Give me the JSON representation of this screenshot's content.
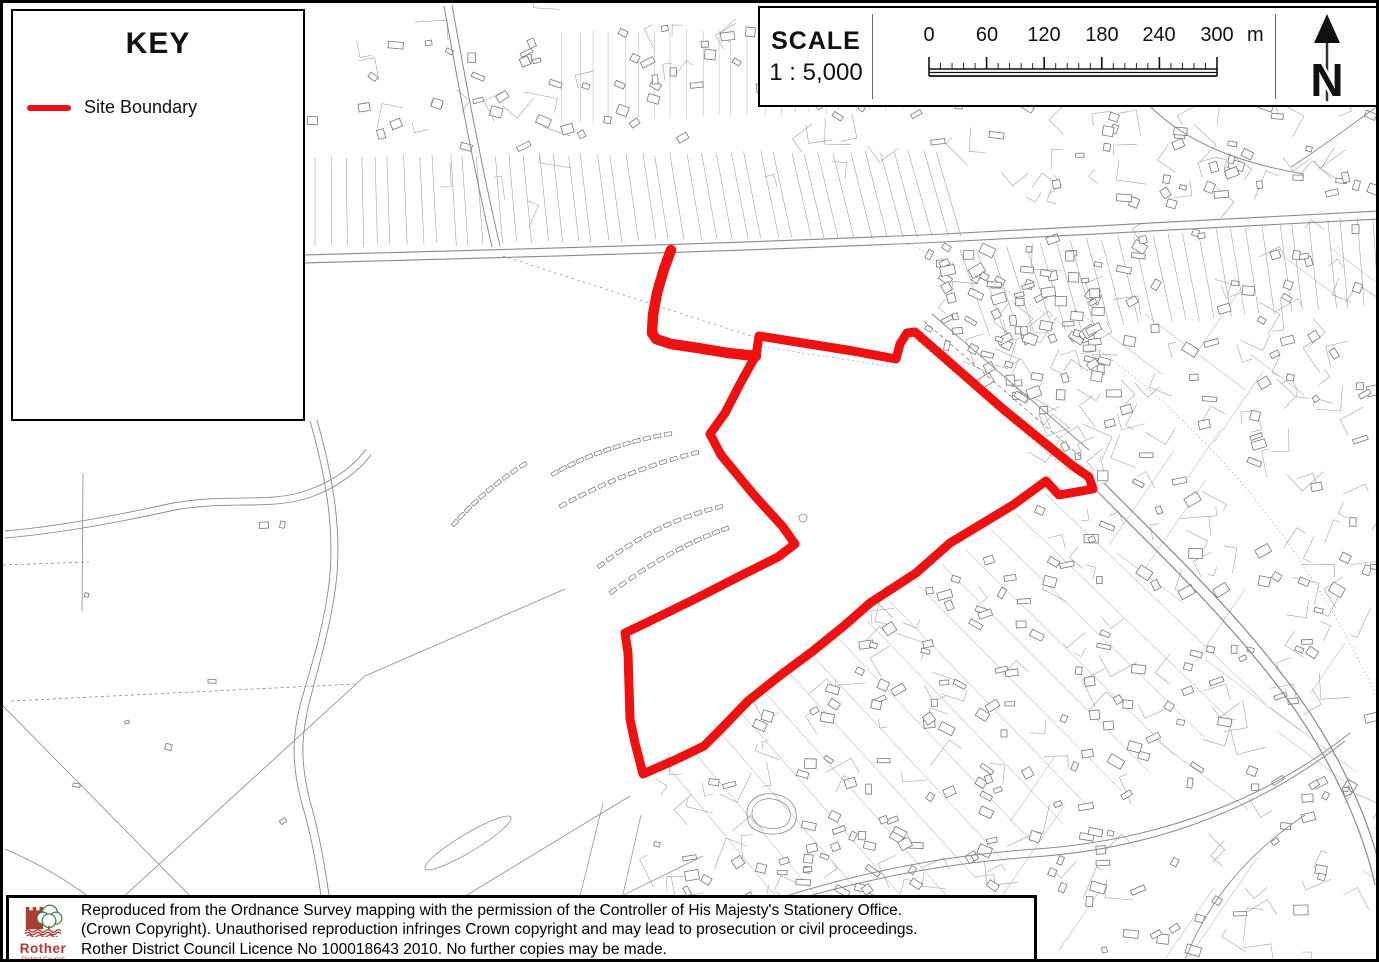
{
  "key_panel": {
    "title": "KEY",
    "legend": [
      {
        "label": "Site Boundary",
        "color": "#ee1111"
      }
    ]
  },
  "scale_panel": {
    "title": "SCALE",
    "ratio": "1 : 5,000",
    "bar": {
      "tick_labels": [
        "0",
        "60",
        "120",
        "180",
        "240",
        "300"
      ],
      "unit": "m",
      "interval_m": 60,
      "total_m": 300
    }
  },
  "north_arrow": {
    "label": "N"
  },
  "credit_panel": {
    "logo_title": "Rother",
    "logo_subtitle": "District Council",
    "lines": [
      "Reproduced from the Ordnance Survey mapping with the permission of the Controller of His Majesty's Stationery Office.",
      "(Crown Copyright). Unauthorised reproduction infringes Crown copyright and may lead to prosecution or civil proceedings.",
      "Rother District Council Licence No 100018643 2010. No further copies may be made."
    ]
  },
  "site_boundary": {
    "name": "Site Boundary",
    "color": "#ee1111",
    "stroke_width": 9,
    "access_spur": [
      [
        668,
        247
      ],
      [
        661,
        266
      ],
      [
        654,
        290
      ],
      [
        650,
        312
      ],
      [
        649,
        330
      ],
      [
        653,
        336
      ],
      [
        668,
        341
      ],
      [
        695,
        345
      ],
      [
        725,
        350
      ],
      [
        753,
        353
      ]
    ],
    "polygon": [
      [
        753,
        353
      ],
      [
        756,
        333
      ],
      [
        800,
        340
      ],
      [
        850,
        348
      ],
      [
        893,
        356
      ],
      [
        897,
        341
      ],
      [
        904,
        330
      ],
      [
        912,
        329
      ],
      [
        1000,
        406
      ],
      [
        1070,
        463
      ],
      [
        1086,
        474
      ],
      [
        1090,
        486
      ],
      [
        1056,
        492
      ],
      [
        1043,
        478
      ],
      [
        1010,
        502
      ],
      [
        947,
        540
      ],
      [
        913,
        570
      ],
      [
        867,
        600
      ],
      [
        842,
        622
      ],
      [
        810,
        648
      ],
      [
        779,
        671
      ],
      [
        745,
        698
      ],
      [
        718,
        726
      ],
      [
        701,
        743
      ],
      [
        672,
        757
      ],
      [
        640,
        771
      ],
      [
        632,
        740
      ],
      [
        627,
        716
      ],
      [
        625,
        650
      ],
      [
        622,
        630
      ],
      [
        645,
        619
      ],
      [
        692,
        596
      ],
      [
        737,
        573
      ],
      [
        775,
        554
      ],
      [
        792,
        541
      ],
      [
        780,
        524
      ],
      [
        751,
        492
      ],
      [
        718,
        452
      ],
      [
        707,
        431
      ],
      [
        722,
        410
      ],
      [
        737,
        381
      ],
      [
        748,
        361
      ]
    ]
  }
}
